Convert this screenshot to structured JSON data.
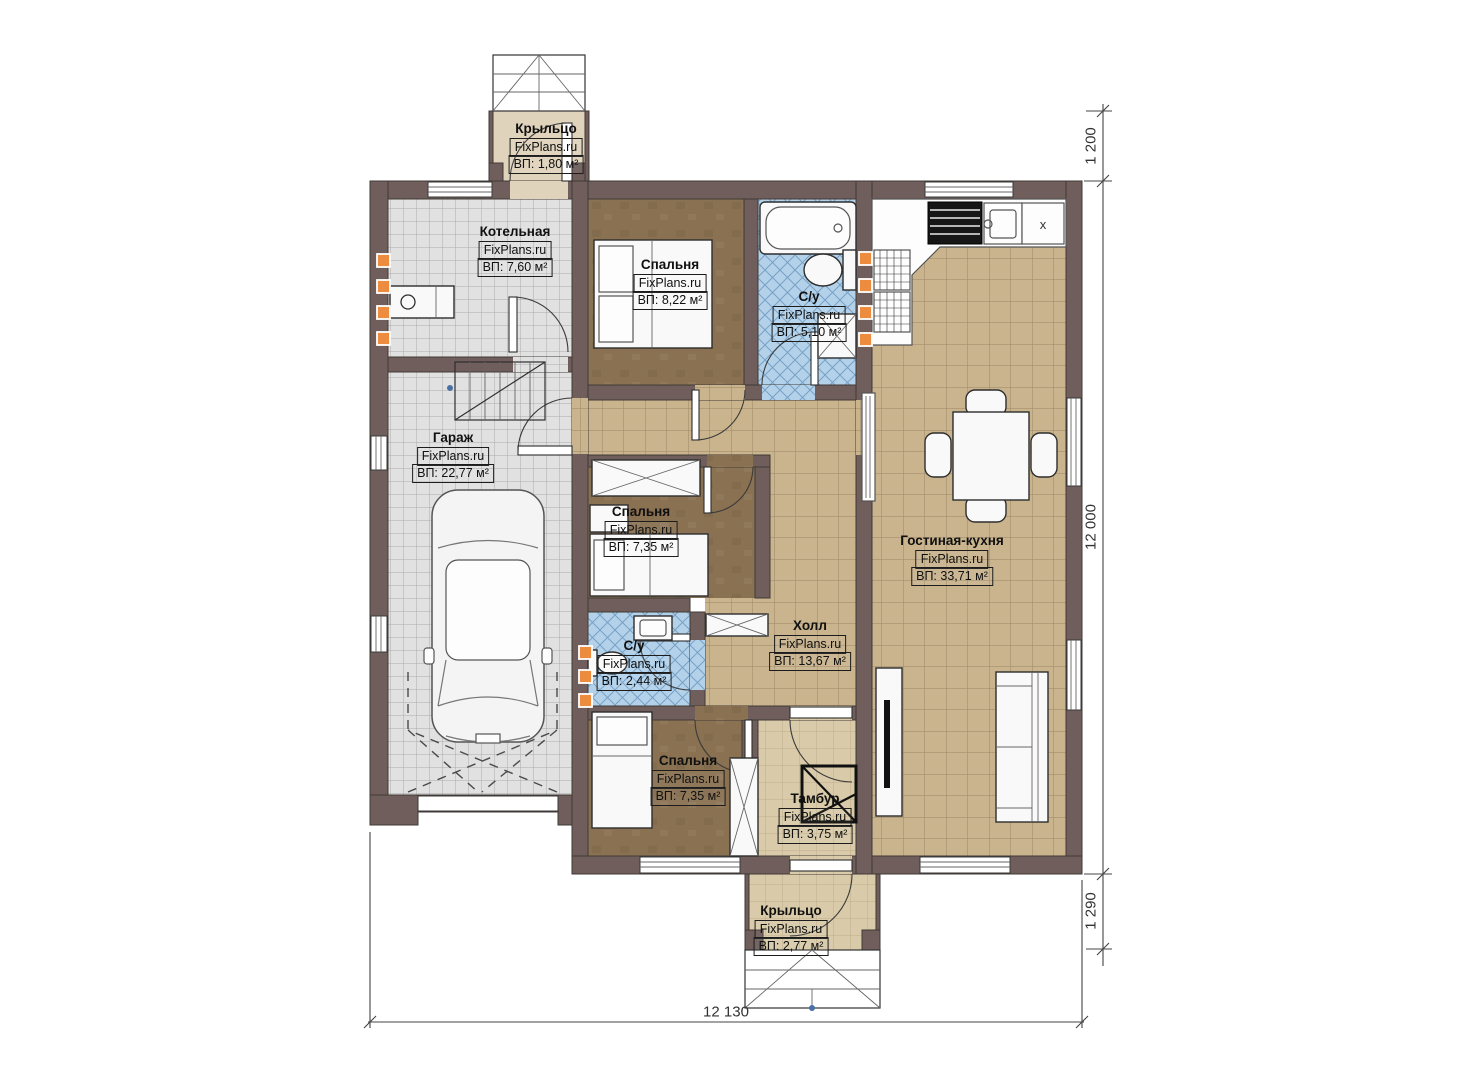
{
  "plan": {
    "watermark": "FixPlans.ru",
    "rooms": [
      {
        "key": "porch-top",
        "name": "Крыльцо",
        "area": "ВП: 1,80 м²"
      },
      {
        "key": "boiler",
        "name": "Котельная",
        "area": "ВП: 7,60 м²"
      },
      {
        "key": "bedroom-1",
        "name": "Спальня",
        "area": "ВП: 8,22 м²"
      },
      {
        "key": "bathroom-1",
        "name": "С/у",
        "area": "ВП: 5,10 м²"
      },
      {
        "key": "garage",
        "name": "Гараж",
        "area": "ВП: 22,77 м²"
      },
      {
        "key": "bedroom-2",
        "name": "Спальня",
        "area": "ВП: 7,35 м²"
      },
      {
        "key": "living-kitchen",
        "name": "Гостиная-кухня",
        "area": "ВП: 33,71 м²"
      },
      {
        "key": "hall",
        "name": "Холл",
        "area": "ВП: 13,67 м²"
      },
      {
        "key": "bathroom-2",
        "name": "С/у",
        "area": "ВП: 2,44 м²"
      },
      {
        "key": "bedroom-3",
        "name": "Спальня",
        "area": "ВП: 7,35 м²"
      },
      {
        "key": "tambour",
        "name": "Тамбур",
        "area": "ВП: 3,75 м²"
      },
      {
        "key": "porch-bottom",
        "name": "Крыльцо",
        "area": "ВП: 2,77 м²"
      }
    ],
    "kitchen": {
      "x_marker": "x"
    },
    "dimensions": {
      "porch_top_depth": "1 200",
      "house_depth": "12 000",
      "porch_bottom_depth": "1 290",
      "house_width": "12 130"
    },
    "colors": {
      "wall": "#6f5e5b",
      "outline": "#423a37",
      "floor_gray": "#e1e1e1",
      "floor_tan": "#c9b48e",
      "floor_brown": "#8a7152",
      "floor_blue": "#b3d2ea",
      "floor_porch": "#e0d3bc",
      "floor_tambour": "#d9cba9",
      "radiator": "#ed8b3e"
    }
  }
}
